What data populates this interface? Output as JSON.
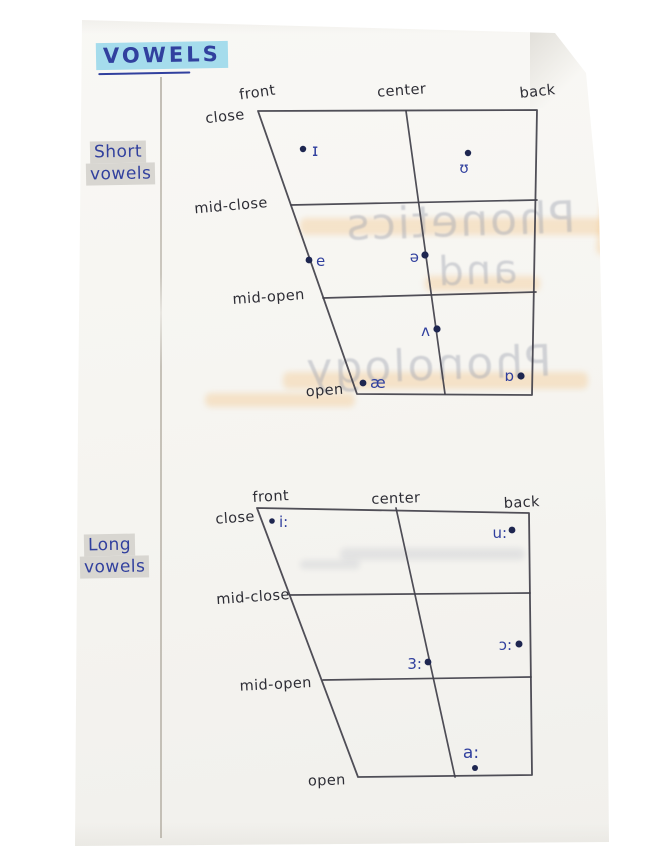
{
  "title": {
    "text": "VOWELS"
  },
  "side_labels": {
    "short": [
      "Short",
      "vowels"
    ],
    "long": [
      "Long",
      "vowels"
    ]
  },
  "colors": {
    "paper": "#f7f6f2",
    "ink_line": "#41404a",
    "pencil_text": "#2d2d35",
    "blue_ink": "#31409e",
    "dot_navy": "#1e2650",
    "title_highlight": "#a5dcec",
    "label_highlight": "#d8d6d1",
    "bleed_grey": "#9aa0ad",
    "bleed_orange": "#f2bc74"
  },
  "bleed_through": [
    {
      "text": "Phonetics",
      "x": 285,
      "y": 196,
      "width": 350,
      "size": 44
    },
    {
      "text": "and",
      "x": 412,
      "y": 248,
      "width": 130,
      "size": 40
    },
    {
      "text": "Phonology",
      "x": 268,
      "y": 340,
      "width": 320,
      "size": 44
    }
  ],
  "charts": [
    {
      "name": "short-vowel-chart",
      "group_label": "Short vowels",
      "outline": [
        [
          258,
          111
        ],
        [
          537,
          110
        ],
        [
          532,
          395
        ],
        [
          357,
          394
        ]
      ],
      "center_line": [
        [
          406,
          111
        ],
        [
          445,
          394
        ]
      ],
      "row_lines": [
        [
          [
            291,
            205
          ],
          [
            537,
            200
          ]
        ],
        [
          [
            323,
            298
          ],
          [
            536,
            292
          ]
        ]
      ],
      "axis_labels": [
        {
          "text": "front",
          "x": 258,
          "y": 97,
          "anchor": "middle",
          "rotate": -8
        },
        {
          "text": "center",
          "x": 402,
          "y": 95,
          "anchor": "middle",
          "rotate": -4
        },
        {
          "text": "back",
          "x": 538,
          "y": 96,
          "anchor": "middle",
          "rotate": -6
        },
        {
          "text": "close",
          "x": 245,
          "y": 119,
          "anchor": "end",
          "rotate": -6
        },
        {
          "text": "mid-close",
          "x": 268,
          "y": 207,
          "anchor": "end",
          "rotate": -5
        },
        {
          "text": "mid-open",
          "x": 305,
          "y": 299,
          "anchor": "end",
          "rotate": -4
        },
        {
          "text": "open",
          "x": 325,
          "y": 395,
          "anchor": "middle",
          "rotate": -4
        }
      ],
      "vowels": [
        {
          "symbol": "ɪ",
          "dot": [
            303,
            149
          ],
          "r": 3.2,
          "label": [
            312,
            156
          ],
          "anchor": "start",
          "size": 17
        },
        {
          "symbol": "ʊ",
          "dot": [
            468,
            153
          ],
          "r": 3.2,
          "label": [
            464,
            173
          ],
          "anchor": "middle",
          "size": 15
        },
        {
          "symbol": "e",
          "dot": [
            309,
            260
          ],
          "r": 3.4,
          "label": [
            316,
            266
          ],
          "anchor": "start",
          "size": 15
        },
        {
          "symbol": "ə",
          "dot": [
            425,
            255
          ],
          "r": 3.6,
          "label": [
            419,
            262
          ],
          "anchor": "end",
          "size": 15
        },
        {
          "symbol": "ʌ",
          "dot": [
            437,
            329
          ],
          "r": 3.6,
          "label": [
            430,
            336
          ],
          "anchor": "end",
          "size": 15
        },
        {
          "symbol": "æ",
          "dot": [
            363,
            383
          ],
          "r": 3.4,
          "label": [
            370,
            388
          ],
          "anchor": "start",
          "size": 16
        },
        {
          "symbol": "ɒ",
          "dot": [
            521,
            376
          ],
          "r": 3.6,
          "label": [
            514,
            381
          ],
          "anchor": "end",
          "size": 15
        }
      ]
    },
    {
      "name": "long-vowel-chart",
      "group_label": "Long vowels",
      "outline": [
        [
          257,
          508
        ],
        [
          529,
          513
        ],
        [
          532,
          775
        ],
        [
          358,
          777
        ]
      ],
      "center_line": [
        [
          396,
          508
        ],
        [
          455,
          777
        ]
      ],
      "row_lines": [
        [
          [
            290,
            595
          ],
          [
            530,
            593
          ]
        ],
        [
          [
            323,
            680
          ],
          [
            531,
            677
          ]
        ]
      ],
      "axis_labels": [
        {
          "text": "front",
          "x": 271,
          "y": 501,
          "anchor": "middle",
          "rotate": -3
        },
        {
          "text": "center",
          "x": 396,
          "y": 503,
          "anchor": "middle",
          "rotate": -2
        },
        {
          "text": "back",
          "x": 522,
          "y": 507,
          "anchor": "middle",
          "rotate": -3
        },
        {
          "text": "close",
          "x": 255,
          "y": 521,
          "anchor": "end",
          "rotate": -4
        },
        {
          "text": "mid-close",
          "x": 290,
          "y": 599,
          "anchor": "end",
          "rotate": -4
        },
        {
          "text": "mid-open",
          "x": 312,
          "y": 687,
          "anchor": "end",
          "rotate": -3
        },
        {
          "text": "open",
          "x": 327,
          "y": 785,
          "anchor": "middle",
          "rotate": -2
        }
      ],
      "vowels": [
        {
          "symbol": "i:",
          "dot": [
            272,
            521
          ],
          "r": 2.8,
          "label": [
            279,
            527
          ],
          "anchor": "start",
          "size": 15
        },
        {
          "symbol": "u:",
          "dot": [
            512,
            530
          ],
          "r": 3.4,
          "label": [
            507,
            538
          ],
          "anchor": "end",
          "size": 15
        },
        {
          "symbol": "ɔ:",
          "dot": [
            519,
            644
          ],
          "r": 3.5,
          "label": [
            512,
            650
          ],
          "anchor": "end",
          "size": 15
        },
        {
          "symbol": "3:",
          "dot": [
            428,
            662
          ],
          "r": 3.4,
          "label": [
            422,
            669
          ],
          "anchor": "end",
          "size": 15
        },
        {
          "symbol": "a:",
          "dot": [
            475,
            768
          ],
          "r": 3.0,
          "label": [
            471,
            758
          ],
          "anchor": "middle",
          "size": 17
        }
      ]
    }
  ]
}
